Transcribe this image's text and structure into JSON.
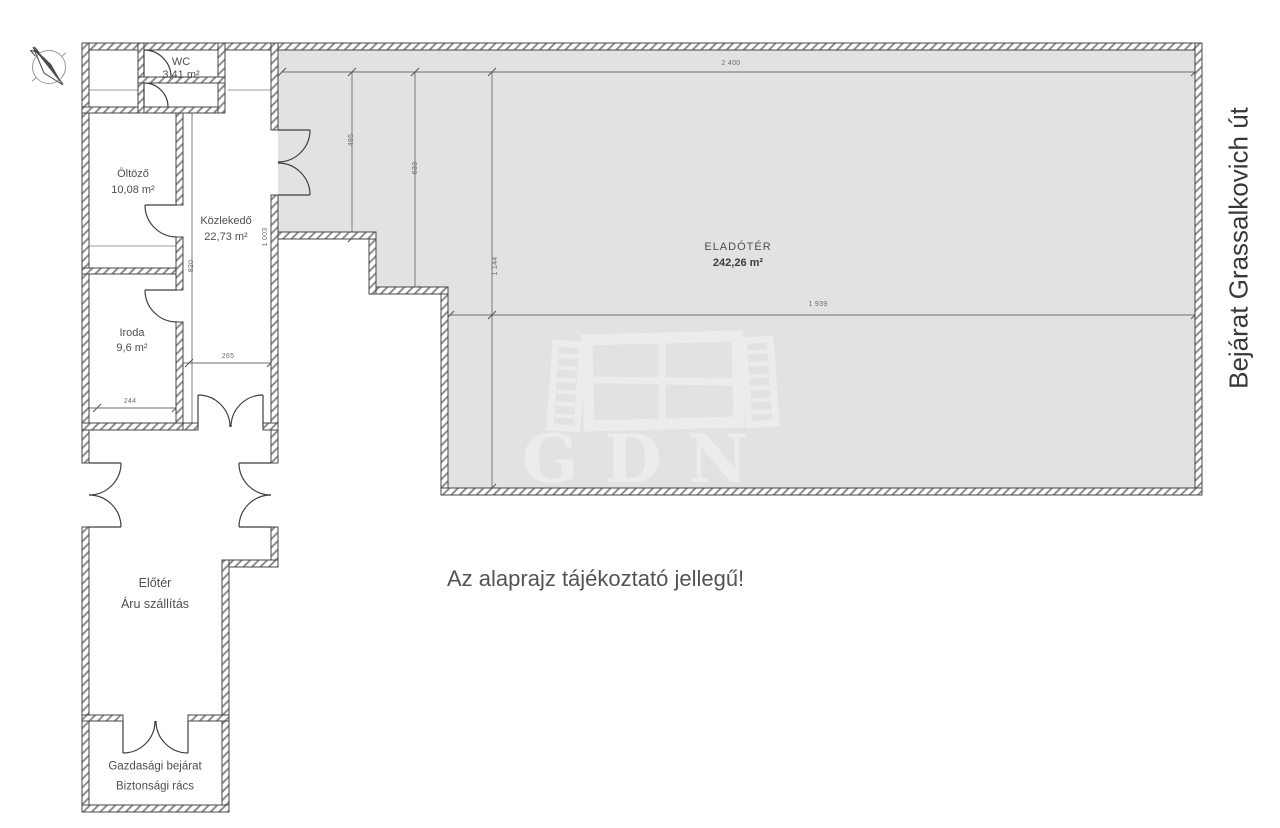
{
  "compass": {
    "north_label": "N"
  },
  "rooms": {
    "wc": {
      "name": "WC",
      "area": "3,41 m²"
    },
    "oltozo": {
      "name": "Öltöző",
      "area": "10,08 m²"
    },
    "kozlekedo": {
      "name": "Közlekedő",
      "area": "22,73 m²"
    },
    "iroda": {
      "name": "Iroda",
      "area": "9,6 m²"
    },
    "eladoter": {
      "name": "ELADÓTÉR",
      "area": "242,26 m²"
    },
    "eloter": {
      "name": "Előtér",
      "subtitle": "Áru szállítás"
    },
    "gazdasagi": {
      "name": "Gazdasági bejárat",
      "subtitle": "Biztonsági rács"
    }
  },
  "dimensions": {
    "d2400": "2 400",
    "d1939": "1 939",
    "d495": "495",
    "d633": "633",
    "d1144": "1 144",
    "d1003": "1 003",
    "d820": "820",
    "d265": "265",
    "d244": "244"
  },
  "annotations": {
    "disclaimer": "Az alaprajz tájékoztató jellegű!",
    "street": "Bejárat Grassalkovich út"
  },
  "watermark": {
    "text": "GDN"
  },
  "colors": {
    "sales_area_fill": "#e2e2e2",
    "wall_stroke": "#474747",
    "hatch": "#8f8f8f",
    "dimension_line": "#6e6e6e",
    "label_text": "#4f4f4f",
    "watermark": "#ececec"
  }
}
